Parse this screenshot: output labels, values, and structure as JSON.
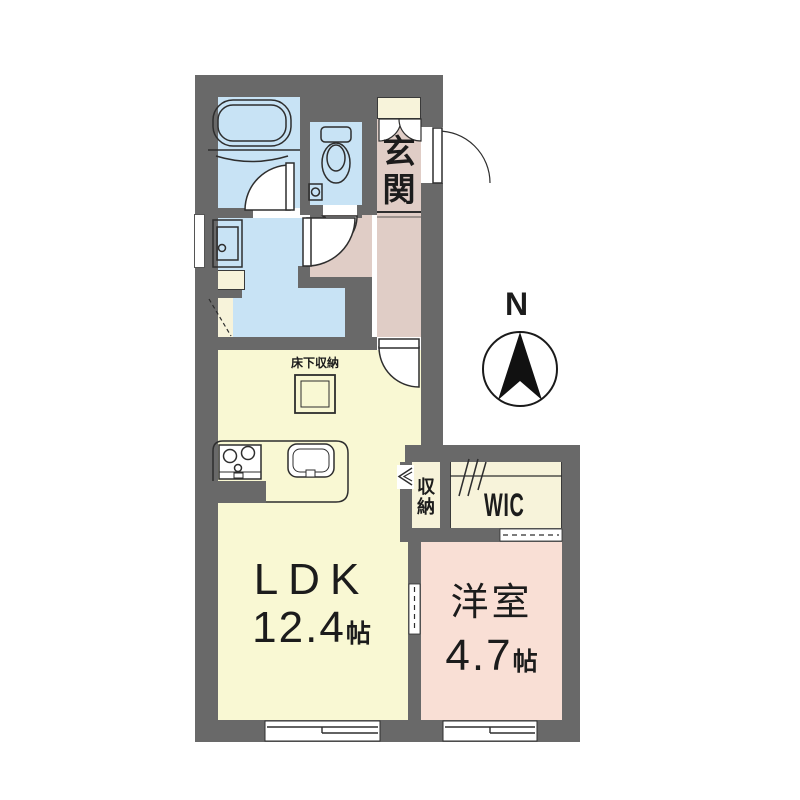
{
  "colors": {
    "wall": "#696969",
    "water": "#c8e3f5",
    "hall": "#e0cdc6",
    "ldk": "#f9f8d3",
    "bedroom": "#f9dfd5",
    "closet": "#f7f3da",
    "line": "#2e2e2e",
    "text": "#1c1c1c"
  },
  "compass": {
    "north_label": "N"
  },
  "rooms": {
    "ldk": {
      "name": "LDK",
      "size_value": "12.4",
      "size_unit": "帖"
    },
    "bedroom": {
      "name": "洋室",
      "size_value": "4.7",
      "size_unit": "帖"
    },
    "entrance": {
      "name": "玄関"
    },
    "wic": {
      "name": "WIC"
    },
    "closet": {
      "name": "収納"
    },
    "floor_storage": {
      "name": "床下収納"
    }
  }
}
